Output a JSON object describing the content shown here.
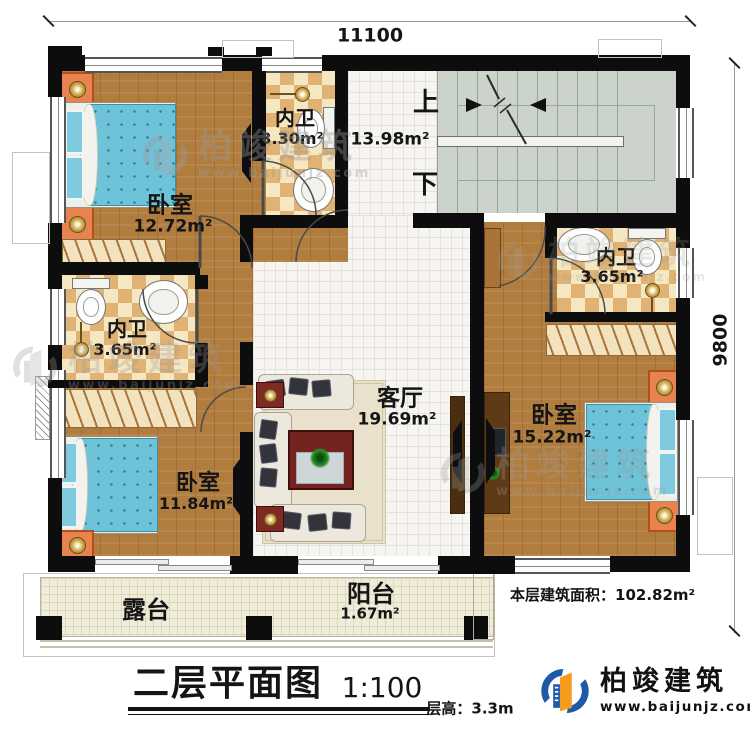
{
  "dimensions": {
    "top": "11100",
    "right": "9800"
  },
  "rooms": {
    "bedroom_tl": {
      "name": "卧室",
      "area": "12.72m²"
    },
    "bath_top": {
      "name": "内卫",
      "area": "3.30m²"
    },
    "hall": {
      "up": "上",
      "down": "下",
      "area": "13.98m²"
    },
    "bath_left": {
      "name": "内卫",
      "area": "3.65m²"
    },
    "bath_right": {
      "name": "内卫",
      "area": "3.65m²"
    },
    "bedroom_bl": {
      "name": "卧室",
      "area": "11.84m²"
    },
    "bedroom_right": {
      "name": "卧室",
      "area": "15.22m²"
    },
    "living_room": {
      "name": "客厅",
      "area": "19.69m²"
    },
    "balcony": {
      "name": "阳台",
      "area": "1.67m²"
    },
    "terrace": {
      "name": "露台"
    }
  },
  "summary": {
    "floor_area_label": "本层建筑面积：",
    "floor_area_value": "102.82m²",
    "floor_height": "层高：3.3m"
  },
  "title_block": {
    "title": "二层平面图",
    "scale": "1:100"
  },
  "brand": {
    "name": "柏竣建筑",
    "url": "www.baijunjz.com"
  },
  "watermark": {
    "name": "柏竣建筑",
    "url": "www.baijunjz.com"
  },
  "colors": {
    "wall": "#0d0d0d",
    "wood": "#b17d3e",
    "tile_dark": "#e0b274",
    "stair": "#cbd3ca",
    "bed": "#6fc3d9",
    "brand_blue": "#1e5aa8",
    "brand_orange": "#f59b20"
  }
}
